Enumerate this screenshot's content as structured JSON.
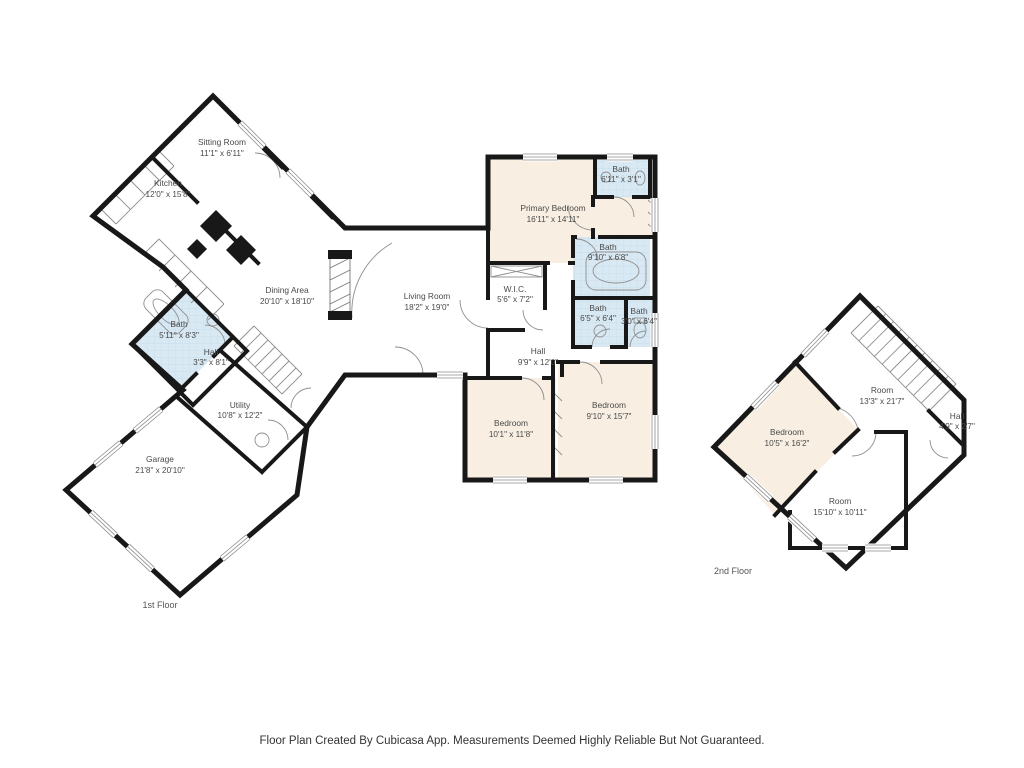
{
  "title": "Floor Plan",
  "colors": {
    "wall": "#181818",
    "bedroom_fill": "#f8efe2",
    "bath_fill": "#d9e9f3",
    "room_fill": "#ffffff",
    "thin_line": "#8f8f8f",
    "label_text": "#4a4a4a"
  },
  "floor1": {
    "label": "1st Floor",
    "sitting_room": {
      "name": "Sitting Room",
      "dims": "11'1\" x 6'11\""
    },
    "kitchen": {
      "name": "Kitchen",
      "dims": "12'0\" x 15'8\""
    },
    "dining": {
      "name": "Dining Area",
      "dims": "20'10\" x 18'10\""
    },
    "living": {
      "name": "Living Room",
      "dims": "18'2\" x 19'0\""
    },
    "primary_bedroom": {
      "name": "Primary Bedroom",
      "dims": "16'11\" x 14'11\""
    },
    "bath_tr": {
      "name": "Bath",
      "dims": "6'11\" x 3'1\""
    },
    "bath_mid": {
      "name": "Bath",
      "dims": "9'10\" x 6'8\""
    },
    "wic": {
      "name": "W.I.C.",
      "dims": "5'6\" x 7'2\""
    },
    "bath_sl": {
      "name": "Bath",
      "dims": "6'5\" x 6'4\""
    },
    "bath_sr": {
      "name": "Bath",
      "dims": "3'0\" x 6'4\""
    },
    "hall": {
      "name": "Hall",
      "dims": "9'9\" x 12'0\""
    },
    "bedroom_left": {
      "name": "Bedroom",
      "dims": "10'1\" x 11'8\""
    },
    "bedroom_right": {
      "name": "Bedroom",
      "dims": "9'10\" x 15'7\""
    },
    "bath_left": {
      "name": "Bath",
      "dims": "5'11\" x 8'3\""
    },
    "hall_left": {
      "name": "Hall",
      "dims": "3'3\" x 8'1\""
    },
    "utility": {
      "name": "Utility",
      "dims": "10'8\" x 12'2\""
    },
    "garage": {
      "name": "Garage",
      "dims": "21'8\" x 20'10\""
    }
  },
  "floor2": {
    "label": "2nd Floor",
    "room_top": {
      "name": "Room",
      "dims": "13'3\" x 21'7\""
    },
    "hall": {
      "name": "Hall",
      "dims": "4'9\" x 2'7\""
    },
    "bedroom": {
      "name": "Bedroom",
      "dims": "10'5\" x 16'2\""
    },
    "room_bottom": {
      "name": "Room",
      "dims": "15'10\" x 10'11\""
    }
  },
  "footer": {
    "text": "Floor Plan Created By Cubicasa App. Measurements Deemed Highly Reliable But Not Guaranteed."
  }
}
